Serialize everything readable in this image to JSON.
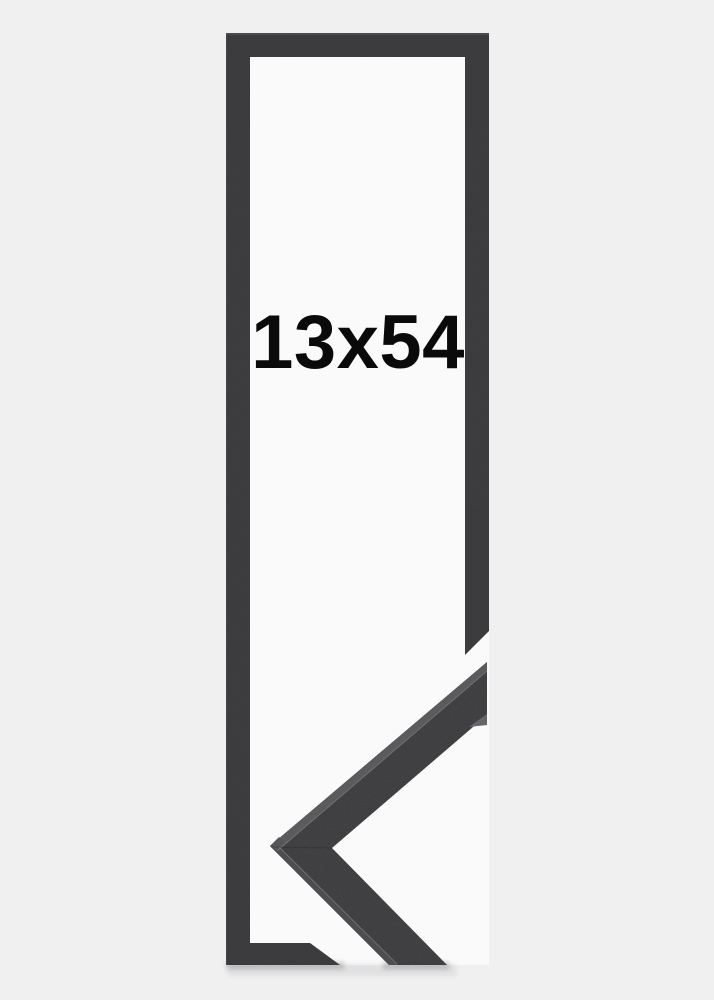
{
  "product_image": {
    "size_label": "13x54",
    "description": "black-frame-product-photo-with-corner-detail"
  },
  "colors": {
    "background": "#f0f0f1",
    "inner_mat": "#fafafa",
    "frame_outline": "#39393b",
    "moulding_face": "#3b3b3d",
    "moulding_top_edge": "#57575a",
    "moulding_side_edge": "#49494c",
    "edge_highlight": "#8d8d90",
    "label_text": "#0a0a0a"
  }
}
